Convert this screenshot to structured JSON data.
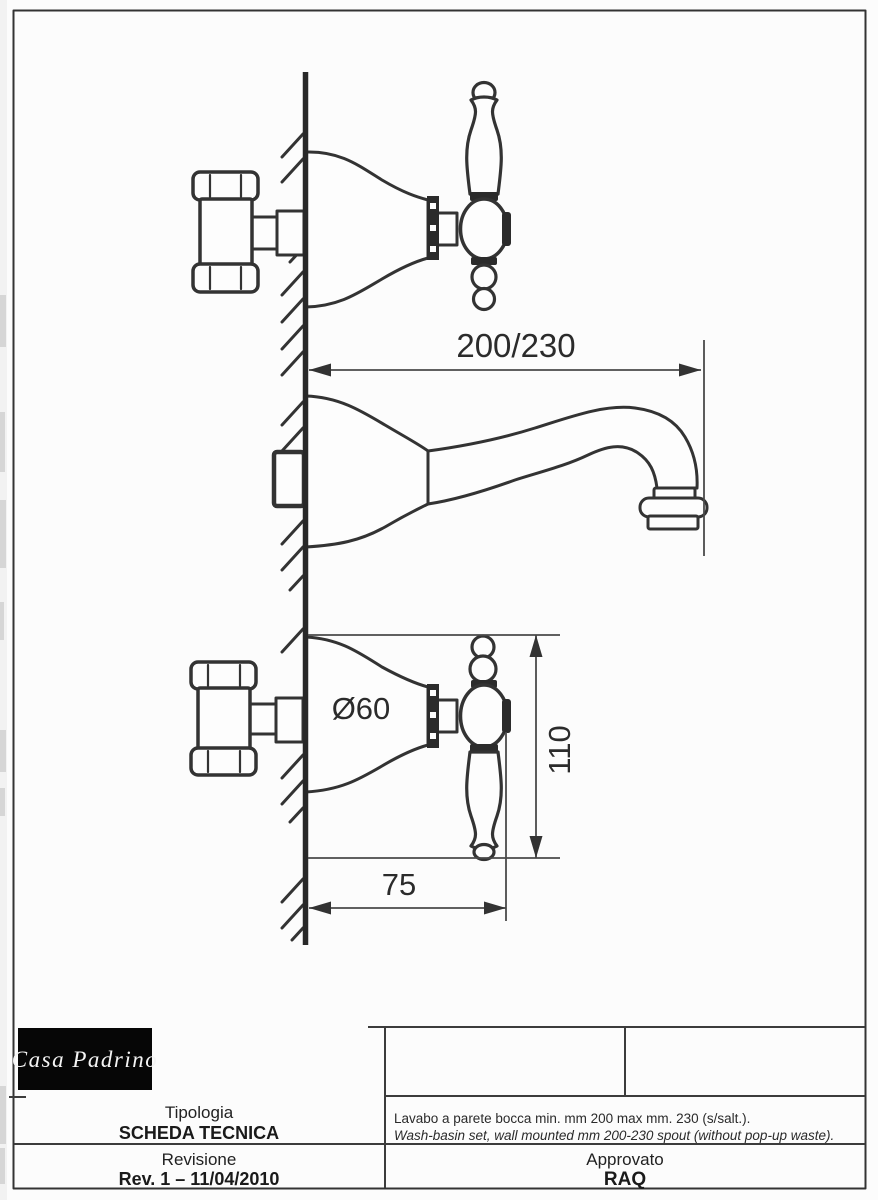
{
  "sheet": {
    "logo_text": "Casa Padrino",
    "tipologia_label": "Tipologia",
    "tipologia_value": "SCHEDA TECNICA",
    "revisione_label": "Revisione",
    "revisione_value": "Rev. 1 – 11/04/2010",
    "approvato_label": "Approvato",
    "approvato_value": "RAQ",
    "description_it": "Lavabo a parete bocca min. mm 200 max mm. 230 (s/salt.).",
    "description_en": "Wash-basin set, wall mounted mm 200-230 spout (without pop-up waste)."
  },
  "drawing": {
    "dim_spout_reach": "200/230",
    "handle_diameter": "Ø60",
    "dim_handle_height": "110",
    "dim_handle_offset": "75"
  },
  "colors": {
    "line": "#333333",
    "dimension": "#4a4a4a",
    "logo_bg": "#060606",
    "logo_fg": "#f4f4f4",
    "paper": "#fcfcfc"
  }
}
